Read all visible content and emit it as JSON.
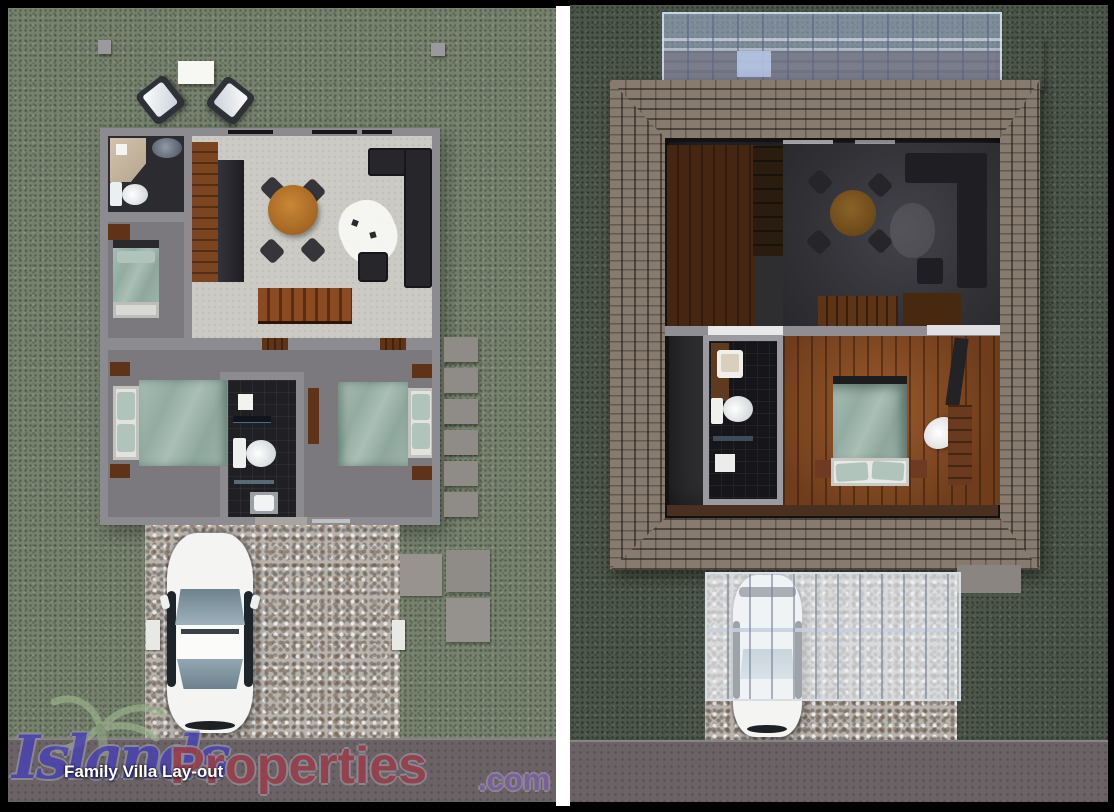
{
  "branding": {
    "watermark_part1": "Islands",
    "watermark_part2": "Properties",
    "watermark_part3": ".com",
    "caption": "Family Villa Lay-out"
  },
  "palette": {
    "frame": "#000000",
    "grass_left": "#76816e",
    "grass_right": "#4d564a",
    "wall": "#8b8b90",
    "floor_light": "#cbcac4",
    "floor_mid": "#7b797d",
    "bath_dark": "#1f1f24",
    "bedding_teal": "#9cb3aa",
    "pillow_teal": "#b0c4bb",
    "furn_dark": "#26262b",
    "wood_brown": "#6e3b1c",
    "table_wood": "#b5742d",
    "pebble": "#b9b3ac",
    "stone": "#8f8b87",
    "road": "#6b6266",
    "roof_shingle": "#877b6f",
    "roof_mortar": "#4e453d",
    "roof_fascia": "#71665d",
    "car_body": "#f4f4f2",
    "glass_tint": "#8fa2ac",
    "wm1": "#4a43b0",
    "wm2": "#9b3d49",
    "wm3": "#7d5fa3",
    "caption": "#ffffff"
  }
}
